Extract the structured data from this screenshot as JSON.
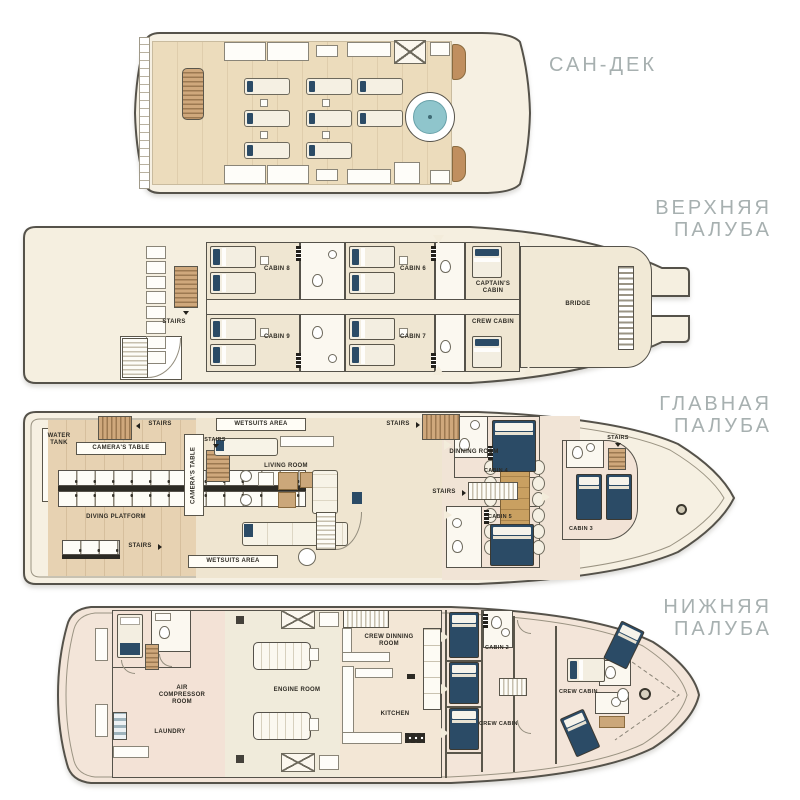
{
  "palette": {
    "navy": "#2b4b66",
    "pool_water": "#8fc5cc",
    "wood": "#c89e73",
    "hull_fill": "#f6f0e2",
    "outline": "#55524a",
    "title_gray": "#a7b0b0"
  },
  "decks": {
    "sun": {
      "title": "САН-ДЕК"
    },
    "upper": {
      "title": "ВЕРХНЯЯ ПАЛУБА",
      "labels": {
        "stairs": "STAIRS",
        "cabin8": "CABIN 8",
        "cabin6": "CABIN 6",
        "captains_cabin": "CAPTAIN'S CABIN",
        "cabin9": "CABIN 9",
        "cabin7": "CABIN 7",
        "crew_cabin": "CREW CABIN",
        "bridge": "BRIDGE"
      }
    },
    "main": {
      "title": "ГЛАВНАЯ ПАЛУБА",
      "labels": {
        "water_tank": "WATER TANK",
        "cameras_table": "CAMERA'S TABLE",
        "stairs": "STAIRS",
        "wetsuits_area": "WETSUITS AREA",
        "diving_platform": "DIVING PLATFORM",
        "living_room": "LIVING ROOM",
        "dinning_room": "DINNING ROOM",
        "cabin4": "CABIN 4",
        "cabin5": "CABIN 5",
        "cabin3": "CABIN 3"
      }
    },
    "lower": {
      "title": "НИЖНЯЯ ПАЛУБА",
      "labels": {
        "air_compressor_room": "AIR COMPRESSOR ROOM",
        "laundry": "LAUNDRY",
        "engine_room": "ENGINE ROOM",
        "crew_dinning_room": "CREW DINNING ROOM",
        "kitchen": "KITCHEN",
        "cabin2": "CABIN 2",
        "crew_cabin": "CREW CABIN"
      }
    }
  }
}
